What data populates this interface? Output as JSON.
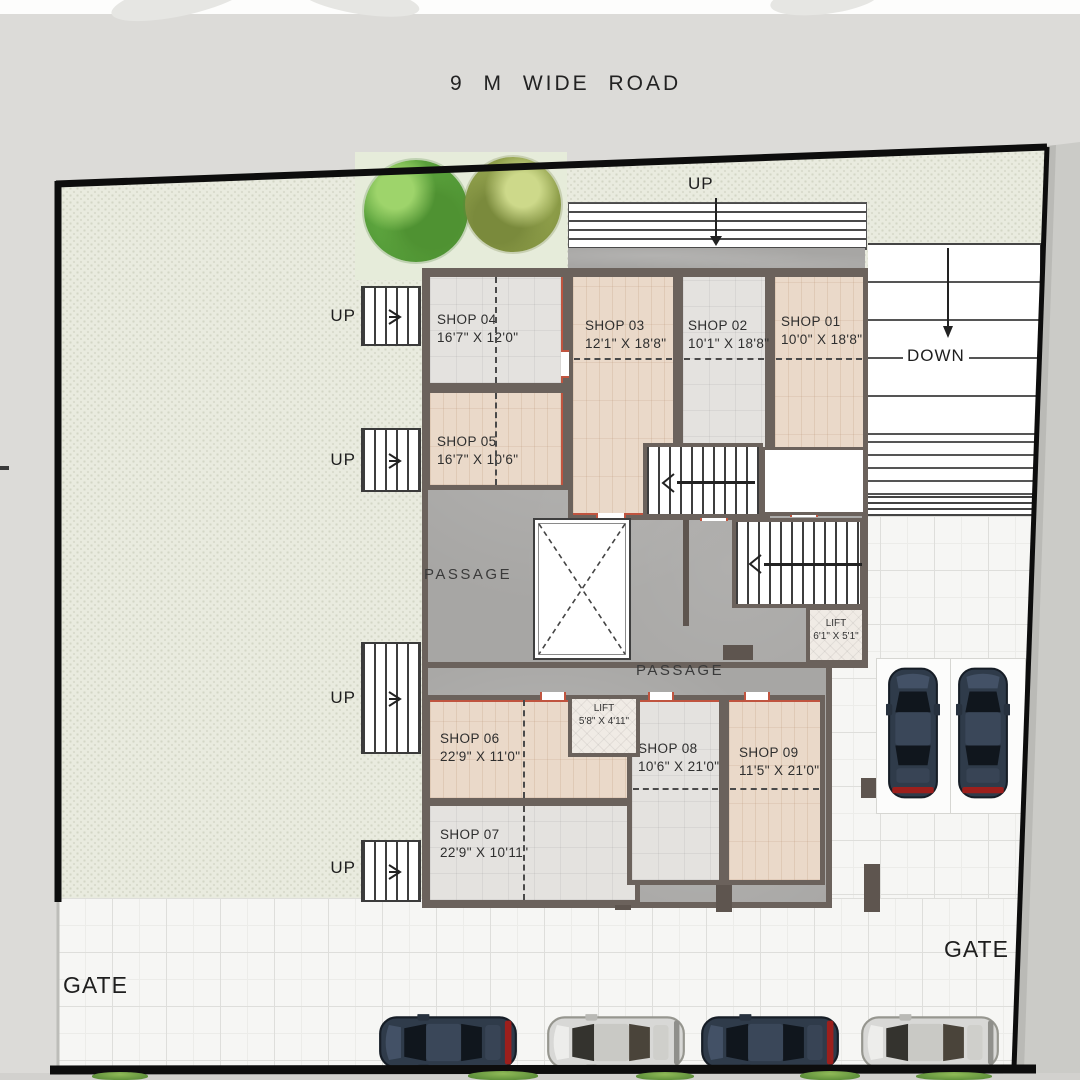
{
  "labels": {
    "road": "9 M  WIDE ROAD",
    "up": "UP",
    "down": "DOWN",
    "passage": "PASSAGE",
    "gate": "GATE"
  },
  "shops": [
    {
      "name": "SHOP 01",
      "dims": "10'0\" X 18'8\""
    },
    {
      "name": "SHOP 02",
      "dims": "10'1\" X 18'8\""
    },
    {
      "name": "SHOP 03",
      "dims": "12'1\" X 18'8\""
    },
    {
      "name": "SHOP 04",
      "dims": "16'7\" X 12'0\""
    },
    {
      "name": "SHOP 05",
      "dims": "16'7\" X 10'6\""
    },
    {
      "name": "SHOP 06",
      "dims": "22'9\" X 11'0\""
    },
    {
      "name": "SHOP 07",
      "dims": "22'9\" X 10'11\""
    },
    {
      "name": "SHOP 08",
      "dims": "10'6\" X 21'0\""
    },
    {
      "name": "SHOP 09",
      "dims": "11'5\" X 21'0\""
    }
  ],
  "lifts": [
    {
      "name": "LIFT",
      "dims": "6'1\" X 5'1\""
    },
    {
      "name": "LIFT",
      "dims": "5'8\" X 4'11\""
    }
  ],
  "colors": {
    "wall": "#6b625c",
    "shop_front_accent": "#c0543f",
    "passage_floor": "#a7a6a4",
    "shop_tile_beige": "#ead9c9",
    "shop_tile_gray": "#e4e2df",
    "courtyard_paving": "#e9ebdf",
    "gate_paving": "#f6f6f4",
    "tree_green": "#5da23c",
    "tree_olive": "#8d9c47",
    "car_dark": "#2f3b4a",
    "car_silver": "#d8d8d6",
    "boundary": "#111111"
  }
}
